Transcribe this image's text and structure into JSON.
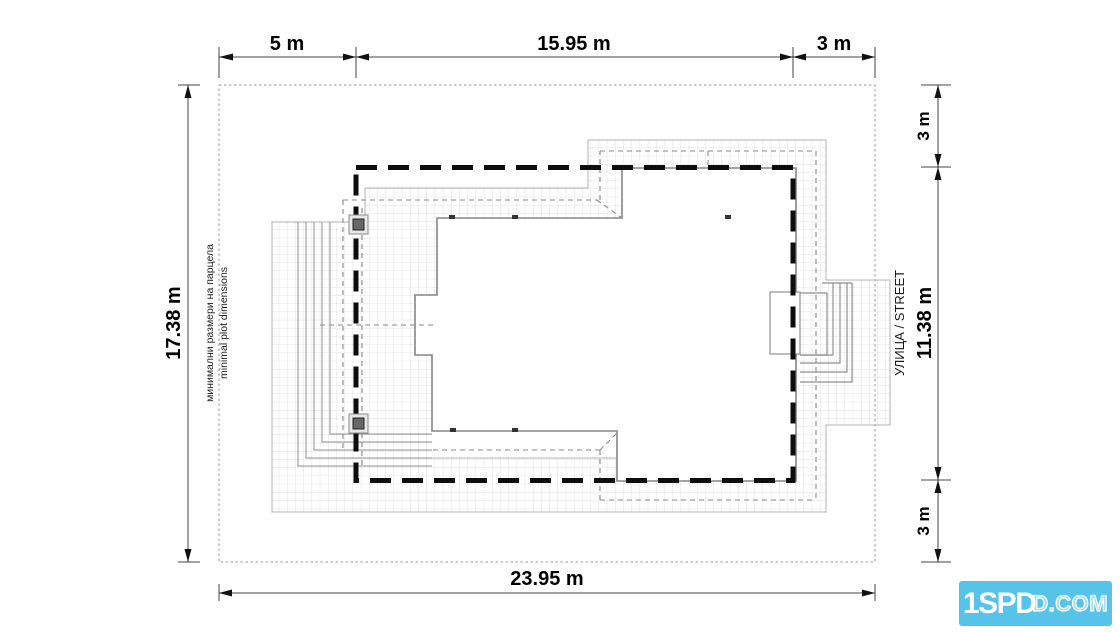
{
  "dimensions": {
    "top_left": "5 m",
    "top_mid": "15.95 m",
    "top_right": "3 m",
    "left": "17.38 m",
    "right_top": "3 m",
    "right_mid": "11.38 m",
    "right_bottom": "3 m",
    "bottom": "23.95 m"
  },
  "labels": {
    "plot_note_bg": "минимални размери на парцела",
    "plot_note_en": "minimal plot dimensions",
    "street": "УЛИЦА / STREET"
  },
  "logo": {
    "solid": "1SPD",
    "outline": "D.COM"
  },
  "colors": {
    "logo_bg": "#58c3e9",
    "envelope_dash": "#0d0d0d",
    "grid_line": "#d9d9d9"
  }
}
